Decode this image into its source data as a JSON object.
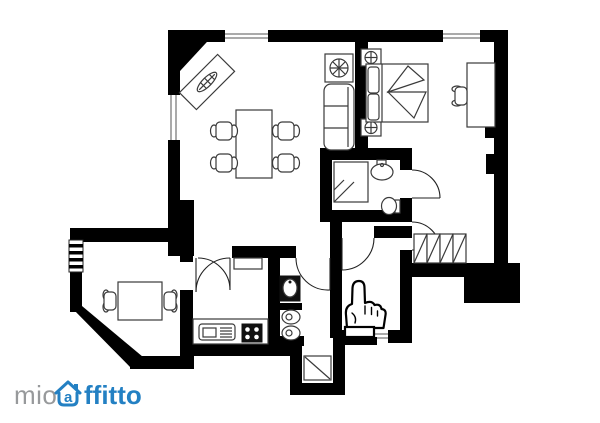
{
  "window": {
    "width": 600,
    "height": 423
  },
  "colors": {
    "background": "#ffffff",
    "wall": "#000000",
    "line": "#3a3a3a",
    "logo-gray": "#97999b",
    "logo-blue": "#2380c3"
  },
  "branding": {
    "logo_prefix": "mio",
    "logo_suffix": "ffitto",
    "logo_house_letter": "a"
  },
  "floorplan": {
    "type": "apartment-floor-plan",
    "symbols": [
      "dining-table-icon",
      "dining-chair-icon",
      "sofa-icon",
      "plant-table-icon",
      "corner-sideboard-icon",
      "double-bed-icon",
      "nightstand-lamp-icon",
      "desk-icon",
      "desk-chair-icon",
      "wardrobe-icon",
      "shower-icon",
      "washbasin-icon",
      "toilet-icon",
      "bidet-icon",
      "kitchen-sink-icon",
      "stove-icon",
      "radiator-icon",
      "window-icon",
      "door-swing-icon",
      "entrance-pointer-icon"
    ]
  }
}
